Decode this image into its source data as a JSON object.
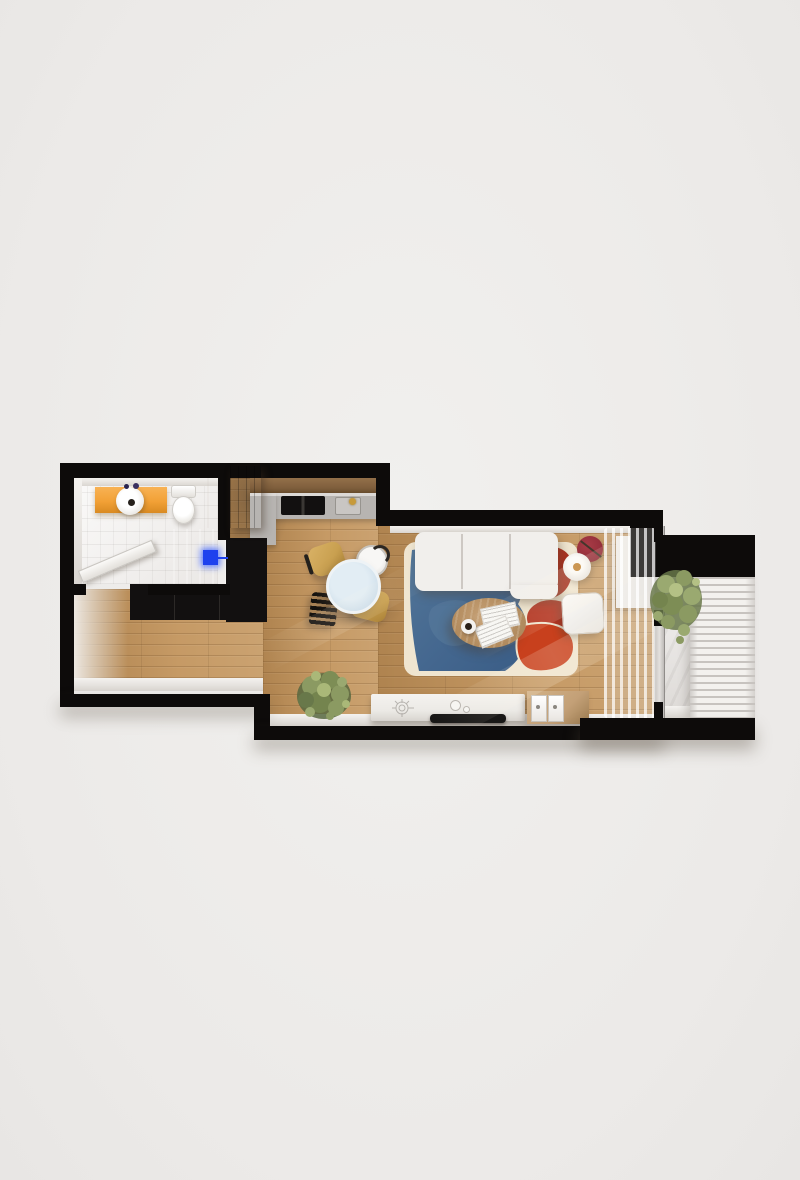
{
  "scene": {
    "kind": "3d-floorplan-top-down-render",
    "subject": "studio apartment with bathroom, kitchen, living-dining room and balcony",
    "colors": {
      "wall": "#0d0b0a",
      "wood_floor": "#bf9058",
      "bathroom_floor": "#f4f2f0",
      "balcony_floor": "#e7e4e1",
      "vanity_orange": "#f2a136",
      "appliance_blue": "#1e41ee",
      "counter_gray": "#b7b4b1",
      "shelf_wood": "#7e5e3c",
      "counter_black": "#121010",
      "faucet_gold": "#c79a3a",
      "table_blue": "#cfdfeb",
      "chair_tan": "#c9a050",
      "rug_cream": "#efe5d0",
      "rug_blue": "#44678f",
      "rug_blue_dark": "#3a5d86",
      "rug_red": "#a93120",
      "rug_red_bright": "#c8401d",
      "sofa_white": "#f1efec",
      "coffee_table_wood": "#b98c58",
      "side_table_red": "#932e3a",
      "lamp_hub": "#bf8030",
      "console_white": "#eceae6",
      "tv_black": "#191817",
      "crate_wood": "#c3a077",
      "railing_white": "#f3f1ee",
      "plant_green": "#8b9a62",
      "plant_green_dark": "#57673f",
      "plant_green_light": "#aab878"
    },
    "rooms": [
      {
        "id": "bathroom",
        "floor": "white-tile"
      },
      {
        "id": "entry",
        "floor": "wood"
      },
      {
        "id": "kitchen",
        "floor": "wood"
      },
      {
        "id": "hallway",
        "floor": "wood"
      },
      {
        "id": "living-dining-room",
        "floor": "wood"
      },
      {
        "id": "balcony",
        "floor": "light-concrete"
      }
    ],
    "furniture": [
      {
        "id": "orange-vanity-with-round-sink",
        "room": "bathroom"
      },
      {
        "id": "toilet",
        "room": "bathroom"
      },
      {
        "id": "dark-wardrobe",
        "room": "bathroom"
      },
      {
        "id": "open-door-leaf",
        "room": "bathroom"
      },
      {
        "id": "washing-machine-blue-display",
        "room": "hallway"
      },
      {
        "id": "black-kitchen-counter-l",
        "room": "kitchen"
      },
      {
        "id": "gray-countertop-with-cooktop-sink-gold-faucet",
        "room": "kitchen"
      },
      {
        "id": "wooden-front-door",
        "room": "entry"
      },
      {
        "id": "round-blue-dining-table",
        "room": "living-dining-room"
      },
      {
        "id": "two-tan-chairs-one-white-one-black-chair",
        "room": "living-dining-room"
      },
      {
        "id": "white-tufted-modular-sofa",
        "room": "living-dining-room"
      },
      {
        "id": "blue-red-cream-area-rug",
        "room": "living-dining-room"
      },
      {
        "id": "oval-wood-coffee-table-with-magazines-and-cup",
        "room": "living-dining-room"
      },
      {
        "id": "red-lounge-chair",
        "room": "living-dining-room"
      },
      {
        "id": "dark-red-side-table",
        "room": "living-dining-room"
      },
      {
        "id": "floor-lamp-round-shade",
        "room": "living-dining-room"
      },
      {
        "id": "white-ottoman",
        "room": "living-dining-room"
      },
      {
        "id": "white-tv-console-with-tv",
        "room": "living-dining-room"
      },
      {
        "id": "wooden-crate-cabinet",
        "room": "living-dining-room"
      },
      {
        "id": "white-side-cabinet",
        "room": "living-dining-room"
      },
      {
        "id": "sheer-curtain",
        "room": "living-dining-room"
      },
      {
        "id": "potted-plant",
        "room": "hallway"
      },
      {
        "id": "balcony-plant",
        "room": "balcony"
      },
      {
        "id": "slatted-railing",
        "room": "balcony"
      }
    ]
  }
}
